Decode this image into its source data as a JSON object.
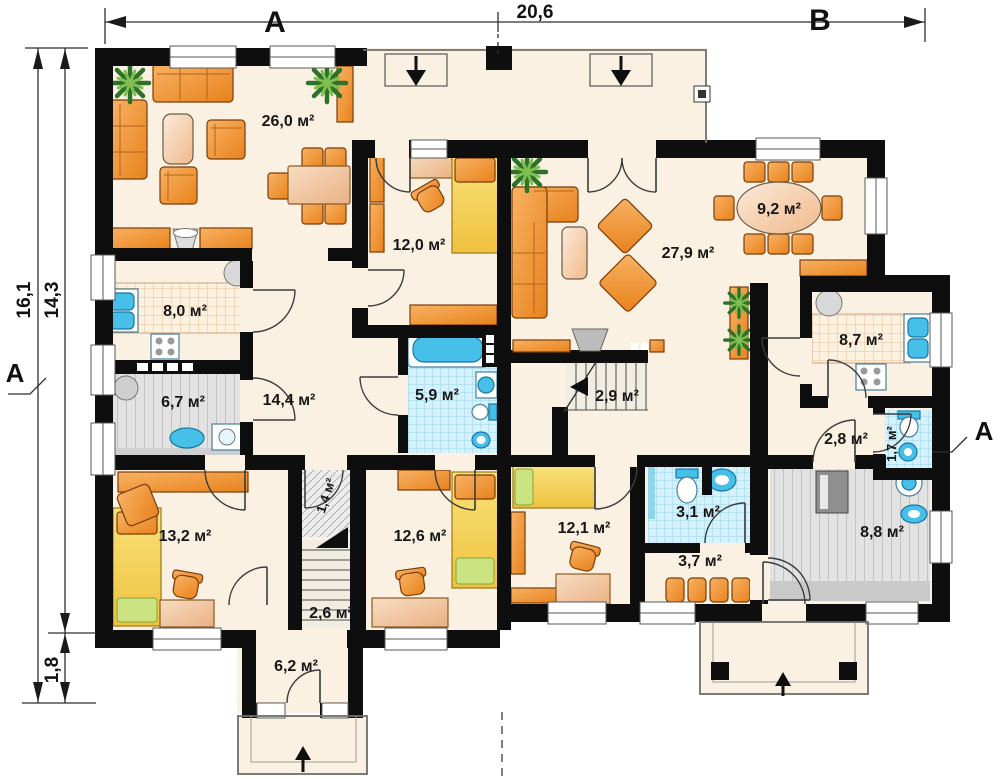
{
  "dimensions": {
    "top_section_a": "A",
    "top_width": "20,6",
    "top_section_b": "B",
    "left_total": "16,1",
    "left_main": "14,3",
    "left_porch": "1,8",
    "section_marker_left": "A",
    "section_marker_right": "A"
  },
  "rooms": {
    "living_a": "26,0 м²",
    "room_a": "12,0 м²",
    "kitchen_a": "8,0 м²",
    "utility_a": "6,7 м²",
    "hall_a": "14,4 м²",
    "bath_a": "5,9 м²",
    "closet_a": "1,4 м²",
    "bedroom_a1": "13,2 м²",
    "stairs_a": "2,6 м²",
    "bedroom_a2": "12,6 м²",
    "entry_a": "6,2 м²",
    "living_b": "27,9 м²",
    "dining_b": "9,2 м²",
    "stairs_b": "2,9 м²",
    "kitchen_b": "8,7 м²",
    "hall_b_small": "2,8 м²",
    "wc_b_small": "1,7 м²",
    "bedroom_b": "12,1 м²",
    "wc_b": "3,1 м²",
    "hall_b": "3,7 м²",
    "utility_b": "8,8 м²"
  },
  "palette": {
    "wall": "#0e0e0e",
    "floor": "#fbf1e2",
    "furniture_orange": "#ef8f2e",
    "bed_yellow": "#f2cd4e",
    "water_blue": "#46bfe9",
    "tile_blue": "#d6f1fb",
    "utility_gray": "#e2e2e2",
    "plant_green": "#2e7128"
  }
}
